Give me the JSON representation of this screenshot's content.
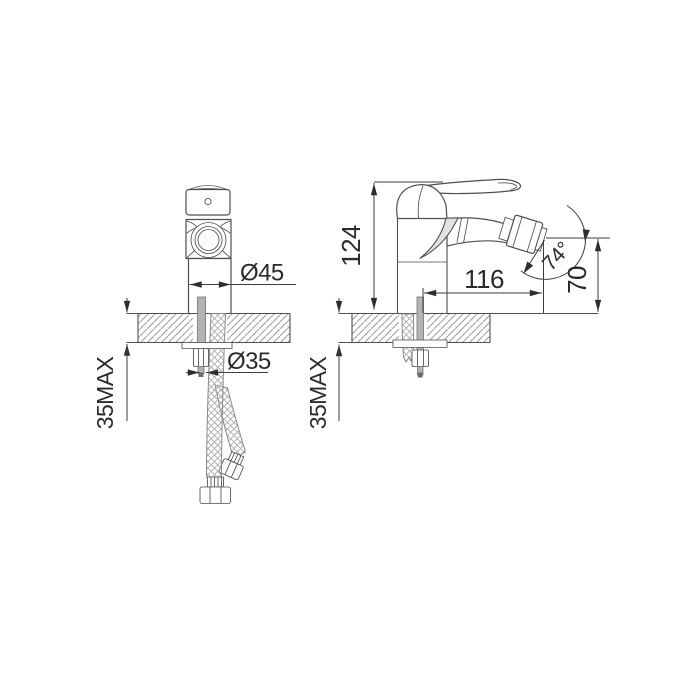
{
  "drawing": {
    "kind": "faucet installation technical drawing, two orthographic views",
    "labels": {
      "diameter_45": "Ø45",
      "diameter_35": "Ø35",
      "max_front": "35MAX",
      "height_124": "124",
      "reach_116": "116",
      "angle_74": "74°",
      "height_70": "70",
      "max_side": "35MAX"
    },
    "colors": {
      "line": "#4f4f4f",
      "dimension_line": "#3d3d3d",
      "text": "#2b2b2b",
      "hatch": "#9c9c9c",
      "braid": "#a9a9a9",
      "metal": "#b3b3b3",
      "background": "#ffffff"
    }
  }
}
